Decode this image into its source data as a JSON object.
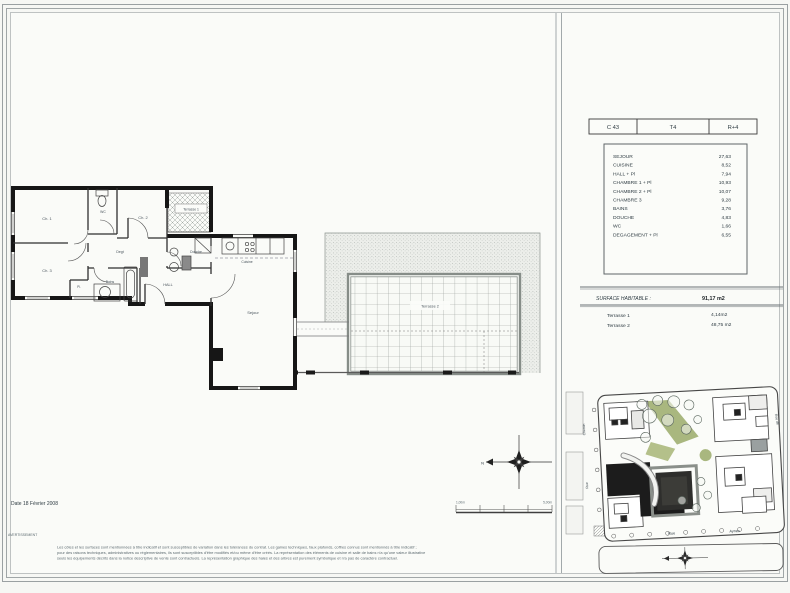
{
  "unit_header": {
    "lot": "C 43",
    "type": "T4",
    "floor": "R+4"
  },
  "room_table": {
    "rows": [
      {
        "label": "SEJOUR",
        "value": "27,63"
      },
      {
        "label": "CUISINE",
        "value": "8,52"
      },
      {
        "label": "HALL + Pl",
        "value": "7,94"
      },
      {
        "label": "CHAMBRE 1 + Pl",
        "value": "10,93"
      },
      {
        "label": "CHAMBRE 2 + Pl",
        "value": "10,07"
      },
      {
        "label": "CHAMBRE 3",
        "value": "9,28"
      },
      {
        "label": "BAINS",
        "value": "3,76"
      },
      {
        "label": "DOUCHE",
        "value": "4,83"
      },
      {
        "label": "WC",
        "value": "1,66"
      },
      {
        "label": "DEGAGEMENT + Pl",
        "value": "6,55"
      }
    ]
  },
  "surface": {
    "label": "SURFACE HABITABLE :",
    "value": "91,17 m2",
    "terrasse1_label": "Terrasse 1",
    "terrasse1_value": "4,14m2",
    "terrasse2_label": "Terrasse 2",
    "terrasse2_value": "48,75 m2"
  },
  "plan": {
    "rooms": {
      "ch1": "Ch. 1",
      "ch2": "Ch. 2",
      "ch3": "Ch. 3",
      "wc": "WC",
      "degt": "Degt",
      "bains": "Bains",
      "pl": "Pl.",
      "douche": "Douche",
      "hall": "HALL",
      "cuisine": "Cuisine",
      "sejour": "Sejour",
      "terrasse1": "Terrasse 1",
      "terrasse2": "Terrasse 2"
    }
  },
  "compass": {
    "north": "N"
  },
  "scale_bar": {
    "left": "1,00m",
    "right": "5,00m"
  },
  "site_map": {
    "streets": {
      "chemin": "Chemin",
      "rue_left": "Rue",
      "rue_bottom": "Rue",
      "aynes": "Aynes",
      "rue_right": "Rue de"
    }
  },
  "footer": {
    "date": "Date 18 Février 2008",
    "warning": "AVERTISSEMENT",
    "line1": "Les côtes et les surfaces sont mentionnées à titre indicatif et sont susceptibles de variation dans les tolérances du contrat. Les gaines techniques, faux plafonds, coffres connus sont mentionnés à titre indicatif ;",
    "line2": "pour des raisons techniques, administratives ou réglementaires, ils sont susceptibles d'être modifiés et/ou même d'être créés. La représentation des éléments de cuisine et salle de bains n'a qu'une valeur illustrative",
    "line3": "seuls les équipements   décrits dans la notice descriptive de vente sont contractuels. La représentation graphique des haies et des arbres est purement symbolique et n'a pas de caractère contractuel."
  },
  "colors": {
    "paper": "#fafbf8",
    "ink": "#161616",
    "line": "#5a6268",
    "green": "#a9b77f"
  }
}
